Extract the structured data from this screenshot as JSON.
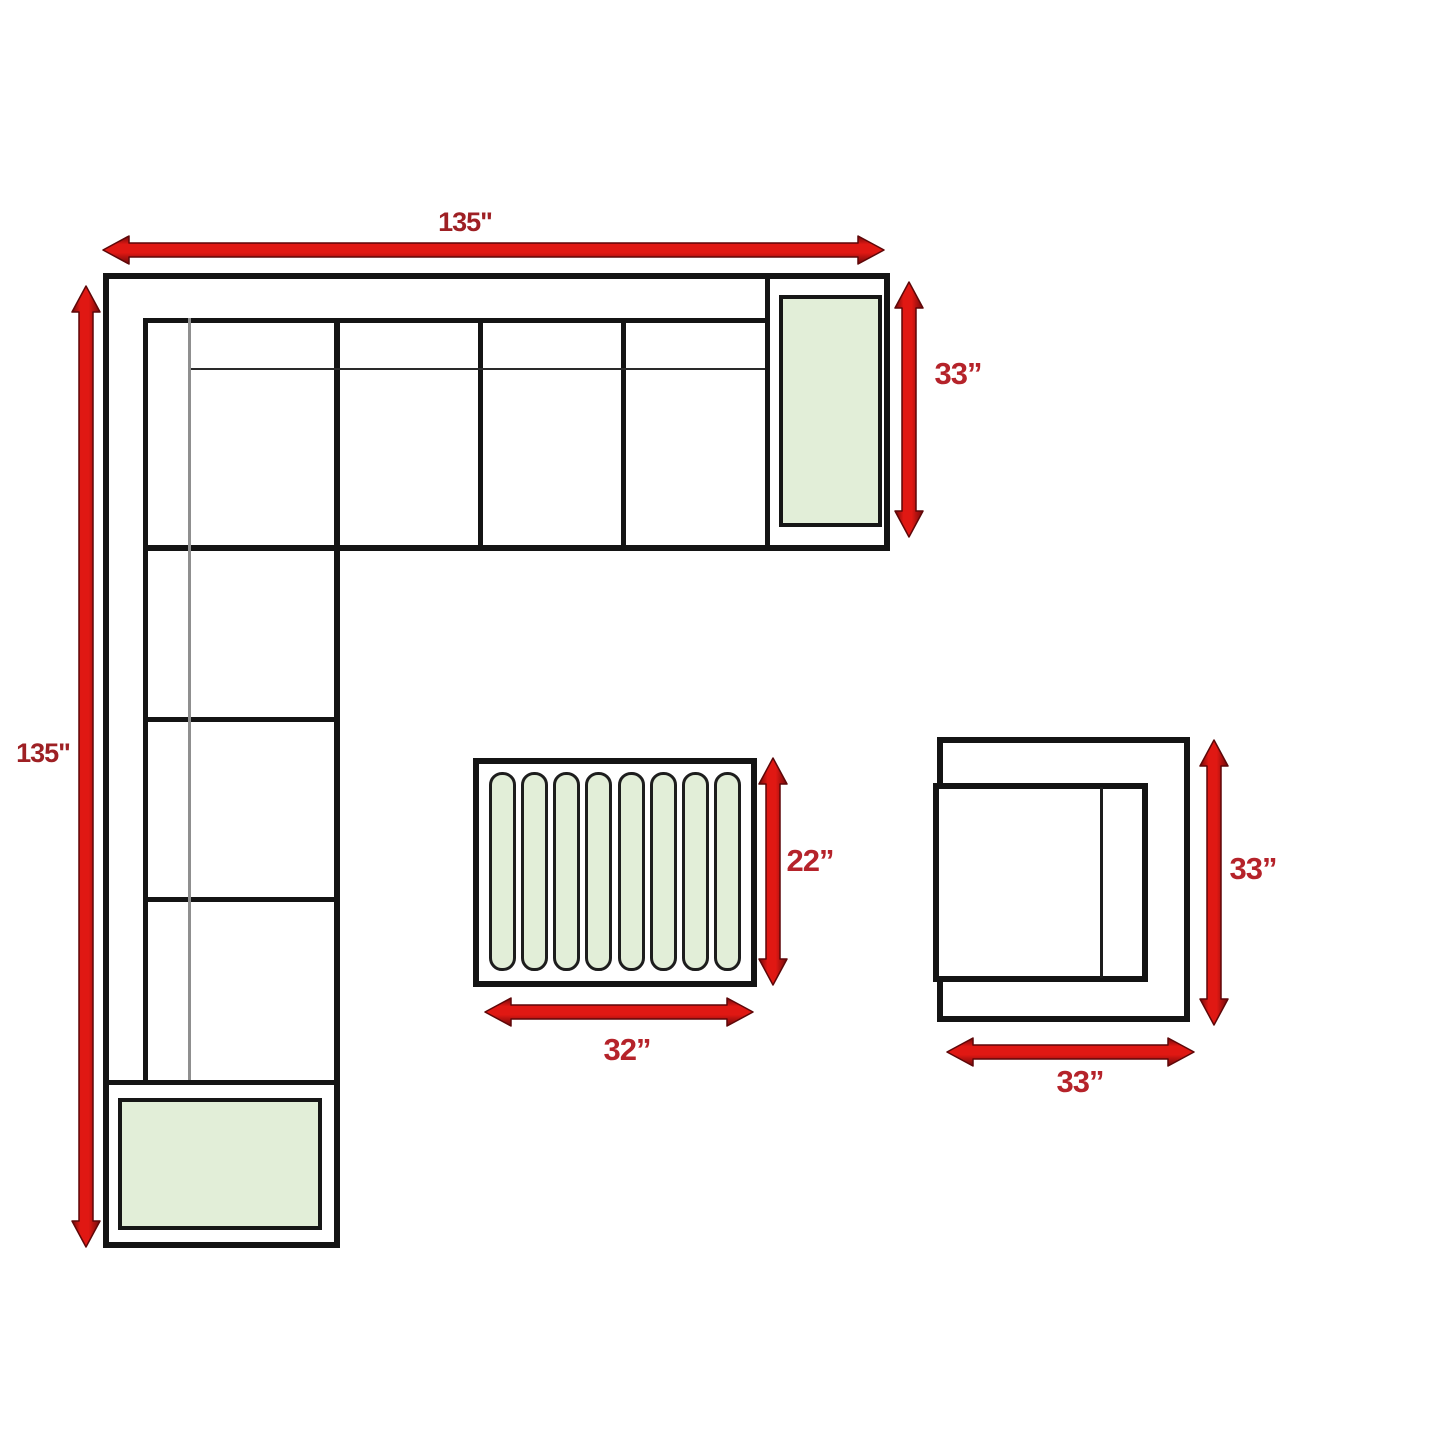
{
  "sectional": {
    "top_width_label": "135\"",
    "left_height_label": "135\"",
    "end_depth_label": "33”"
  },
  "coffee_table": {
    "depth_label": "22”",
    "width_label": "32”",
    "slat_count": 8
  },
  "armchair": {
    "height_label": "33”",
    "width_label": "33”"
  },
  "colors": {
    "arrow_red": "#d31013",
    "arrow_edge": "#6f0a0b",
    "label_red": "#a82025",
    "outline_black": "#141414",
    "cushion_green": "#e2eed8"
  }
}
